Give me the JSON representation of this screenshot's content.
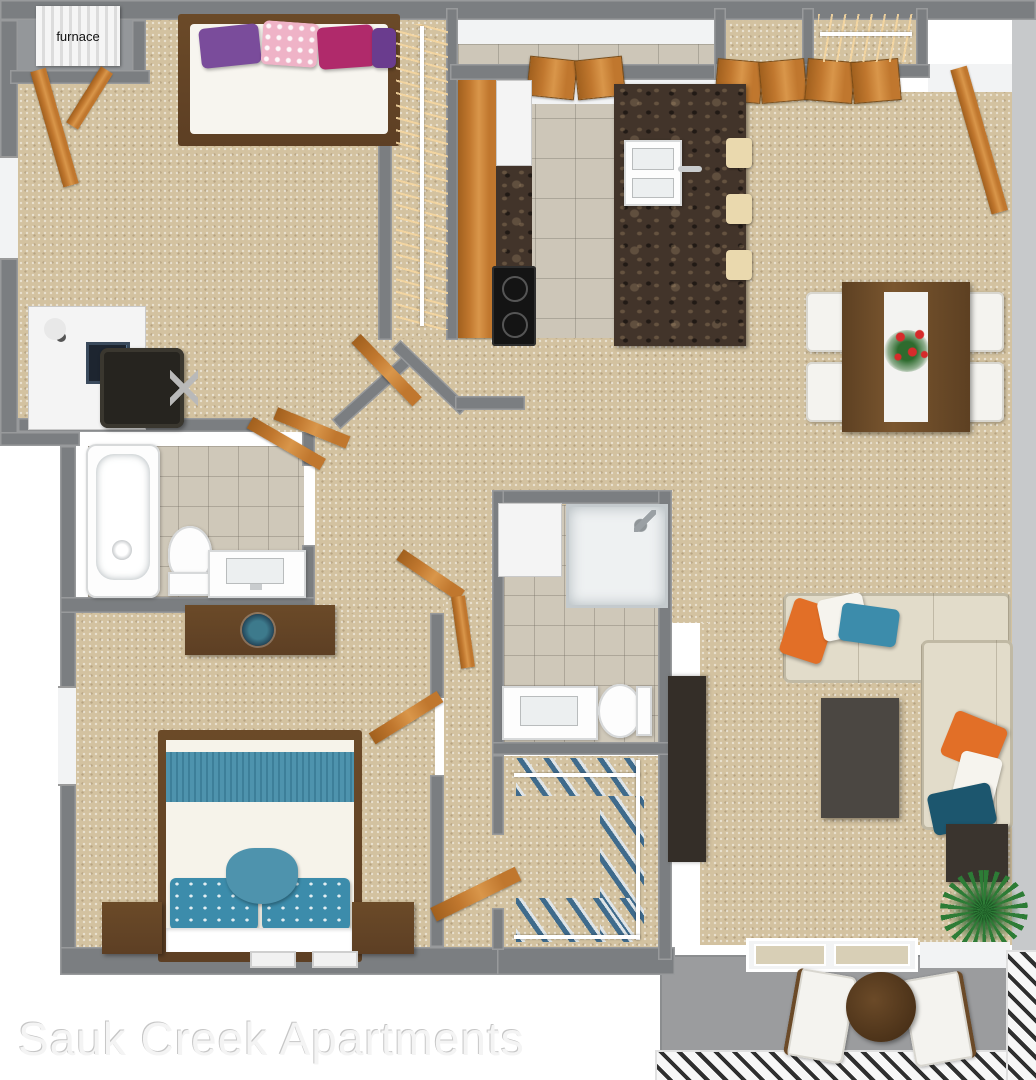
{
  "watermark": {
    "text": "Sauk Creek Apartments"
  },
  "furnace": {
    "label": "furnace"
  },
  "colors": {
    "wall": "#7b7e81",
    "wall_light": "#c7c9cb",
    "carpet": "#d3c2a0",
    "tile": "#cdc6b8",
    "bath_tile": "#cfc8b9",
    "wood": "#c0772e",
    "dark_wood": "#5d3f24",
    "counter": "#42342a",
    "appliance_white": "#f4f4f4",
    "stove_black": "#141414",
    "sofa": "#e2dcca",
    "pillow_orange": "#e26f27",
    "pillow_teal": "#3c8cab",
    "pillow_dark_teal": "#1c566e",
    "pillow_purple": "#7a4c9b",
    "pillow_magenta": "#b02a6b",
    "pillow_pink": "#efb3c7",
    "bed_teal": "#4e93ad",
    "furniture_gray": "#4b4742",
    "media_dark": "#342e28",
    "balcony": "#9b9c9e",
    "plant": "#2d7c36"
  }
}
